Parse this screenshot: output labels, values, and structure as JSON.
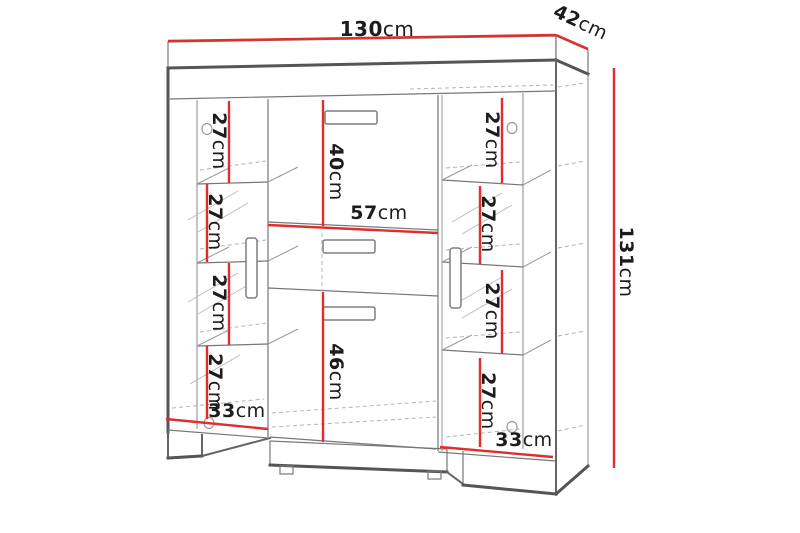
{
  "image_type": "furniture-dimension-diagram",
  "product": "display-cabinet-technical-drawing",
  "colors": {
    "dimension_line": "#e02e2e",
    "outline": "#555555",
    "detail_line": "#7a7a7a",
    "text": "#1c1c1c",
    "background": "#ffffff"
  },
  "dimensions": {
    "width": {
      "value": "130",
      "unit": "cm"
    },
    "depth": {
      "value": "42",
      "unit": "cm"
    },
    "height": {
      "value": "131",
      "unit": "cm"
    },
    "middle_top": {
      "value": "40",
      "unit": "cm"
    },
    "middle_width": {
      "value": "57",
      "unit": "cm"
    },
    "middle_bottom": {
      "value": "46",
      "unit": "cm"
    },
    "bottom_left": {
      "value": "33",
      "unit": "cm"
    },
    "bottom_right": {
      "value": "33",
      "unit": "cm"
    },
    "left_shelf_gaps": [
      {
        "value": "27",
        "unit": "cm"
      },
      {
        "value": "27",
        "unit": "cm"
      },
      {
        "value": "27",
        "unit": "cm"
      },
      {
        "value": "27",
        "unit": "cm"
      }
    ],
    "right_shelf_gaps": [
      {
        "value": "27",
        "unit": "cm"
      },
      {
        "value": "27",
        "unit": "cm"
      },
      {
        "value": "27",
        "unit": "cm"
      },
      {
        "value": "27",
        "unit": "cm"
      }
    ]
  }
}
